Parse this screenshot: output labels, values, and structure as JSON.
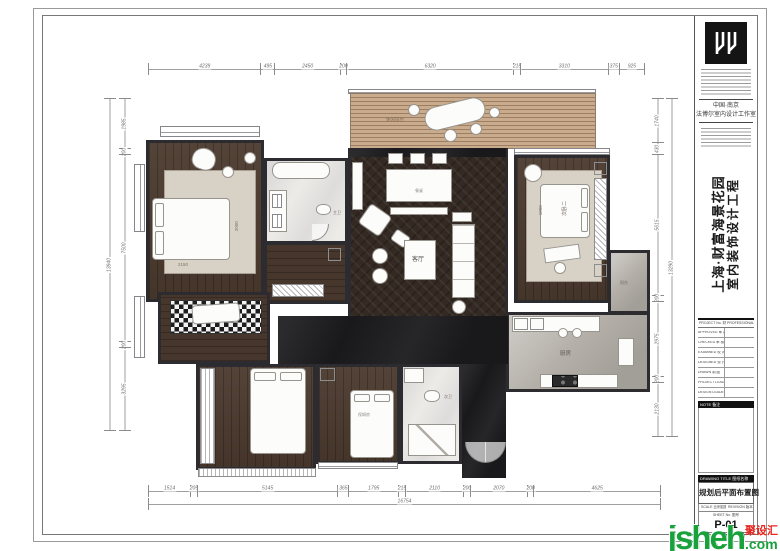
{
  "colors": {
    "wall": "#2c2c30",
    "dark_wood": "#4a392d",
    "herringbone": "#342a23",
    "balcony_wood": "#c9ab8d",
    "white_marble": "#edebe7",
    "gray_marble": "#b4b0a9",
    "black_marble": "#19181b",
    "rug": "#d8d1c5",
    "watermark_green": "#19a23c",
    "watermark_red": "#e8251f"
  },
  "dims": {
    "top": [
      "4239",
      "495",
      "2450",
      "200",
      "6320",
      "215",
      "3310",
      "375",
      "925"
    ],
    "bottom": [
      "1514",
      "205",
      "5145",
      "365",
      "1795",
      "215",
      "2110",
      "200",
      "2070",
      "200",
      "4625"
    ],
    "bottom_total": "16754",
    "left": [
      "1985",
      "200",
      "7500",
      "200",
      "3295"
    ],
    "left_total": "13940",
    "right": [
      "1740",
      "430",
      "5615",
      "200",
      "2975",
      "200",
      "2130"
    ],
    "right_total": "13290"
  },
  "rooms": {
    "balcony": "休闲阳台",
    "living": "客厅",
    "bedroom2": "次卧二",
    "kitchen": "厨房",
    "bath_master": "主卫",
    "bath_second": "次卫",
    "nanny": "保姆房",
    "service_balcony": "阳台",
    "table_line1": "餐桌",
    "table_line2": "2200*1400",
    "bed_master_w": "2150",
    "bed_master_d": "2000",
    "bed2_w": "1800"
  },
  "title_block": {
    "country": "中国·南京",
    "studio": "法博尔室内设计工作室",
    "project_title_line1": "上海·财富海景花园",
    "project_title_line2": "室内装饰设计工程",
    "header_left": "PROJECT No. 财富海景",
    "header_right": "PROFESSIONAL 专业",
    "rows": [
      {
        "en": "APPROVED",
        "cn": "审 定"
      },
      {
        "en": "CHECKED",
        "cn": "审 核"
      },
      {
        "en": "EXAMINED",
        "cn": "校 对"
      },
      {
        "en": "DESIGNED",
        "cn": "设 计"
      },
      {
        "en": "DRAWN",
        "cn": "制 图"
      },
      {
        "en": "PROJECT LEADER",
        "cn": "项目负责人"
      },
      {
        "en": "DESIGN LEADER",
        "cn": "设计负责人"
      }
    ],
    "note_label": "NOTE 备注",
    "drawing_title_label": "DRAWING TITLE 图纸名称",
    "drawing_title": "规划后平面布置图",
    "scale_label": "SCALE 比例如图",
    "revision_label": "REVISION 版本",
    "sheet_label": "SHEET No. 图号",
    "sheet_no": "P-01"
  },
  "watermark": {
    "brand": "jsheh",
    "cn": "聚设汇",
    "com": ".com"
  }
}
